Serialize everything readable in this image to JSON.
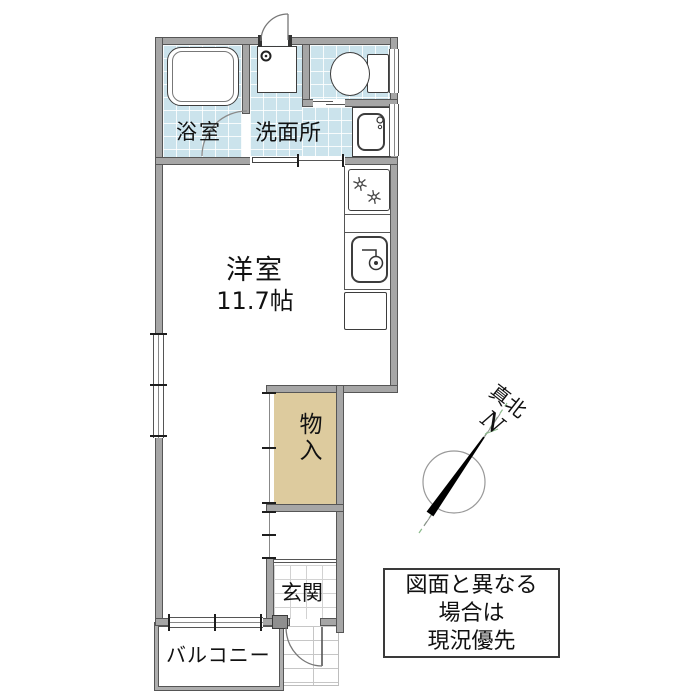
{
  "plan": {
    "rooms": {
      "bathroom": "浴室",
      "washroom": "洗面所",
      "main_room": "洋室",
      "main_room_size": "11.7帖",
      "storage": "物入",
      "entrance": "玄関",
      "balcony": "バルコニー"
    },
    "compass": {
      "true_north": "真北",
      "n": "N"
    },
    "disclaimer": {
      "line1": "図面と異なる",
      "line2": "場合は",
      "line3": "現況優先"
    },
    "colors": {
      "tile": "#cbe3ec",
      "storage_fill": "#ddcb9e",
      "wall_fill": "#a6a6a6",
      "wall_edge": "#565656",
      "compass_needle": "#000000",
      "compass_green": "#8cbb8c"
    }
  }
}
